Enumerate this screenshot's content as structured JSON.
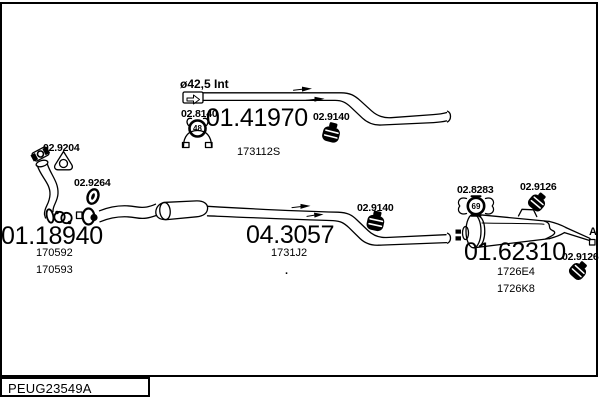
{
  "frame": {
    "footer_code": "PEUG23549A"
  },
  "diagram": {
    "pipe_note": "ø42,5 Int",
    "end_marker": "A",
    "stray_dot": ".",
    "parts": [
      {
        "number": "01.41970",
        "oe": [
          "173112S"
        ]
      },
      {
        "number": "01.18940",
        "oe": [
          "170592",
          "170593"
        ]
      },
      {
        "number": "04.3057",
        "oe": [
          "1731J2"
        ]
      },
      {
        "number": "01.62310",
        "oe": [
          "1726E4",
          "1726K8"
        ]
      }
    ],
    "refs": {
      "flange_gasket": "02.9204",
      "oring": "02.9264",
      "exhaust_gasket": "02.8140",
      "exhaust_gasket_size": "48",
      "clamp_top": "02.9140",
      "clamp_mid": "02.9140",
      "rubber_hanger": "02.8283",
      "rubber_hanger_size": "69",
      "clamp_rear_top": "02.9126",
      "clamp_rear_end": "02.9126"
    }
  }
}
